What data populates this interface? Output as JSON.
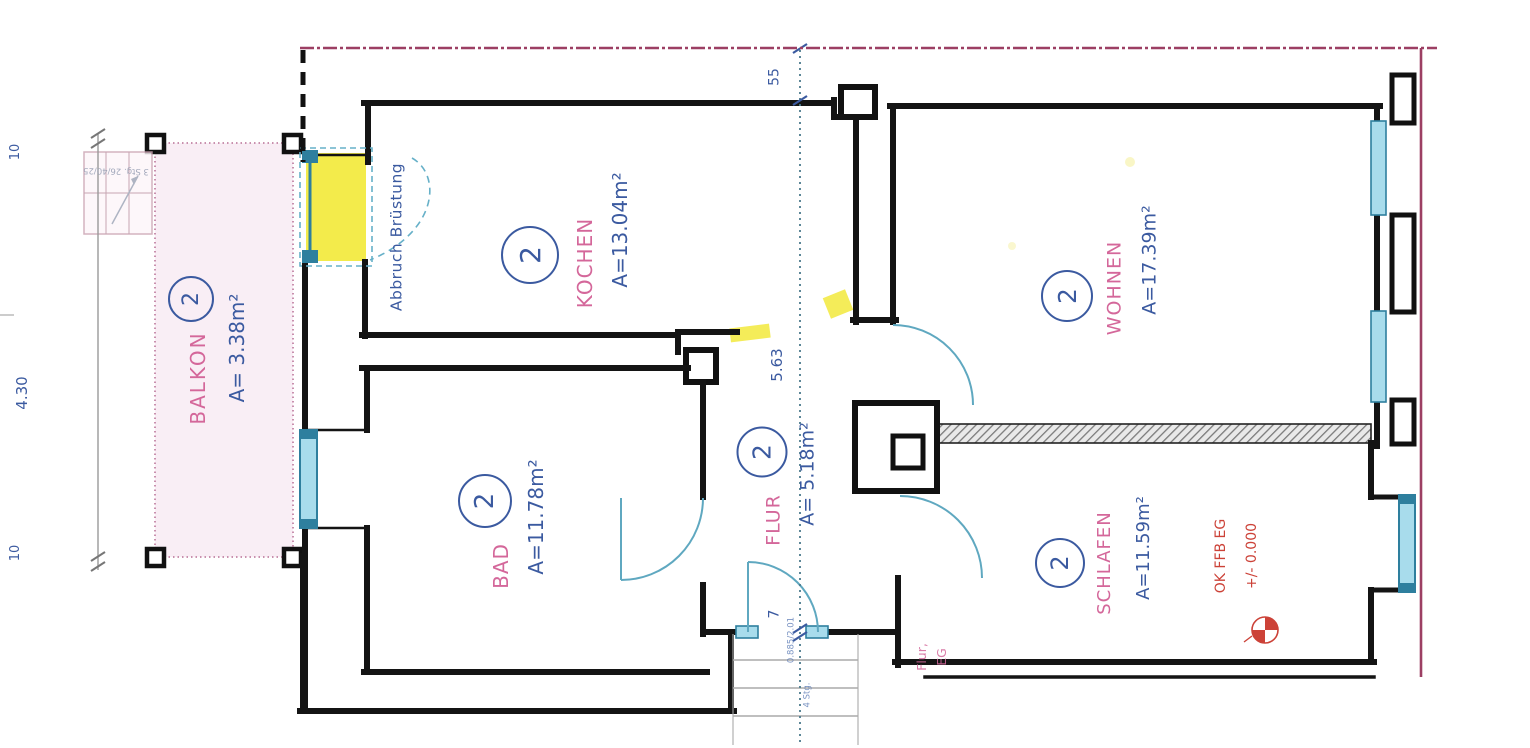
{
  "plan": {
    "rooms": [
      {
        "key": "balkon",
        "number": "2",
        "name": "BALKON",
        "area": "A= 3.38m²"
      },
      {
        "key": "kochen",
        "number": "2",
        "name": "KOCHEN",
        "area": "A=13.04m²"
      },
      {
        "key": "bad",
        "number": "2",
        "name": "BAD",
        "area": "A=11.78m²"
      },
      {
        "key": "flur",
        "number": "2",
        "name": "FLUR",
        "area": "A= 5.18m²"
      },
      {
        "key": "wohnen",
        "number": "2",
        "name": "WOHNEN",
        "area": "A=17.39m²"
      },
      {
        "key": "schlafen",
        "number": "2",
        "name": "SCHLAFEN",
        "area": "A=11.59m²"
      }
    ],
    "annotations": {
      "abbruch_bruestung": "Abbruch Brüstung",
      "level_label": "OK FFB EG",
      "level_value": "+/- 0.000",
      "flur_eg_line1": "Flur,",
      "flur_eg_line2": "EG",
      "balcony_stair_note": "3 Stg. 26/40/25",
      "entrance_door_note": "0.885/2.01",
      "entrance_step_note": "4 Stg."
    },
    "dimensions": {
      "left_top": "10",
      "left_middle": "4.30",
      "left_bottom": "10",
      "wall_thickness": "55",
      "flur_length": "5.63",
      "threshold": "7"
    },
    "colors": {
      "wall": "#1a1a1a",
      "window": "#a8dcec",
      "window_frame": "#2e7f9e",
      "demolition_yellow": "#f2e93c",
      "boundary_pink": "#9c3f63",
      "room_label_pink": "#d4679a",
      "dimension_blue": "#3b5aa0",
      "level_red": "#cc4238",
      "balcony_fill": "#f9eef5"
    }
  }
}
